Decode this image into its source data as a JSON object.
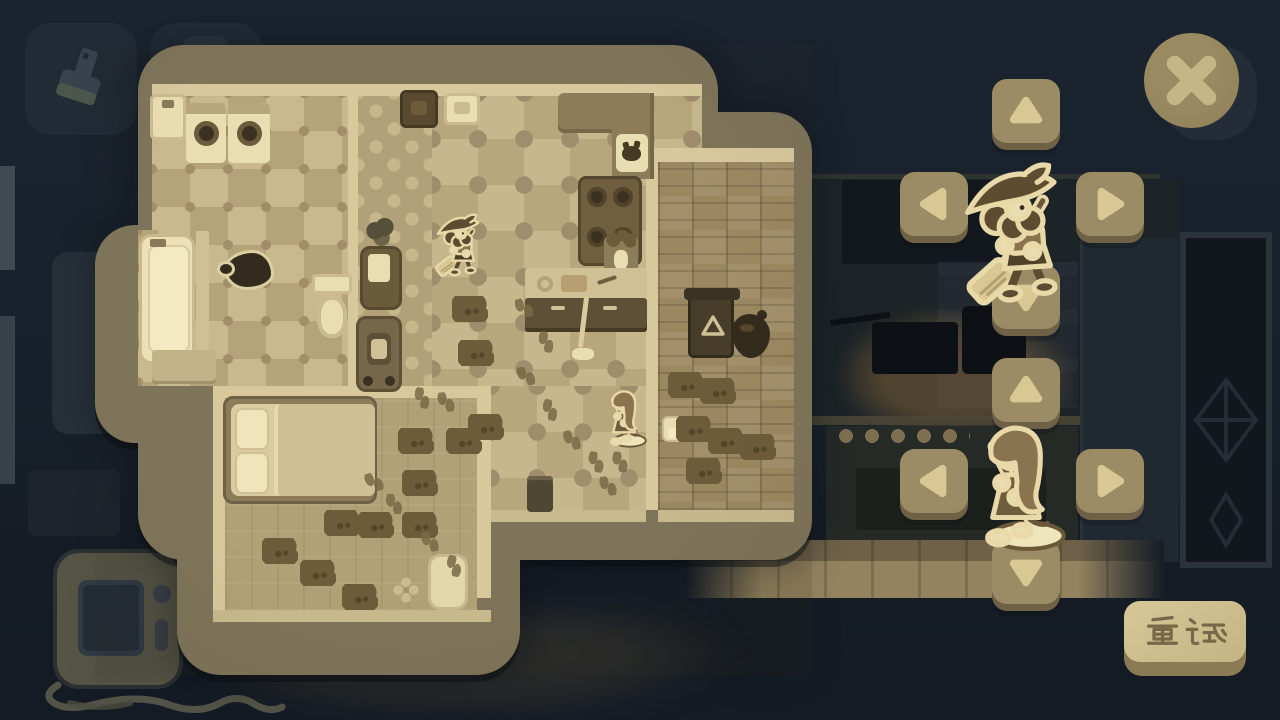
{
  "palette": {
    "bg": "#18212b",
    "bg_dark": "#141b24",
    "panel_border": "#7e745a",
    "wall": "#d8c99d",
    "wall_lip": "#c9ba8e",
    "checker_a": "#c9b98e",
    "checker_b": "#b5a479",
    "puzzle_a": "#c7b78c",
    "puzzle_b": "#b8a77c",
    "puzzle_dot": "#a08d6c",
    "corridor": "#b1a078",
    "parquet": "#9c8860",
    "carpet": "#b1a176",
    "cream": "#e9ddb2",
    "cream_bright": "#f1e7c0",
    "dark_furniture": "#5a4b30",
    "counter_dark": "#5e5036",
    "counter_top": "#cfc096",
    "mud": "#6d5c3a",
    "mud_dark": "#55462a",
    "footprint": "#7b6946",
    "stain": "#332c1e",
    "stain_outline": "#dcd0a2",
    "btn_face": "#9c8c65",
    "btn_arrow": "#d9c894",
    "btn_lip": "#6e6146",
    "close_face": "#8f8058",
    "close_x": "#c6b585",
    "close_shadow": "#242d37",
    "retry_face": "#cdbd8d",
    "retry_side": "#8a7b55",
    "retry_text_color": "#776849",
    "sprite_outline": "#ead9a8",
    "sprite_dark": "#5f4c30",
    "sprite_mid": "#8a7450",
    "sprite_cream": "#e9dcae",
    "hud_btn": "#212b36",
    "hud_icon": "#39434e",
    "console_body": "#555445",
    "console_screen": "#242e37"
  },
  "hud": {
    "brush_button": {
      "icon": "brush-icon"
    },
    "extra_button": {
      "icon": "button-behind-panel"
    },
    "close_button": {
      "icon": "close-x-icon"
    },
    "retry_button": {
      "label": "重试"
    }
  },
  "dpads": [
    {
      "id": "witch",
      "character": "witch-with-broom",
      "buttons": [
        {
          "dir": "up"
        },
        {
          "dir": "left"
        },
        {
          "dir": "right"
        },
        {
          "dir": "down"
        }
      ]
    },
    {
      "id": "maid",
      "character": "maid-with-mop",
      "buttons": [
        {
          "dir": "up"
        },
        {
          "dir": "left"
        },
        {
          "dir": "right"
        },
        {
          "dir": "down"
        }
      ]
    }
  ],
  "map": {
    "rooms": [
      {
        "name": "laundry-bathroom",
        "floor": "checker-tile"
      },
      {
        "name": "hallway",
        "floor": "clover-tile"
      },
      {
        "name": "kitchen-living",
        "floor": "puzzle-tile"
      },
      {
        "name": "wood-room",
        "floor": "parquet"
      },
      {
        "name": "bedroom",
        "floor": "carpet"
      }
    ],
    "objects": [
      "laundry-sink",
      "washing-machine",
      "washing-machine",
      "bathtub",
      "shower-divider",
      "toilet",
      "dresser",
      "dirt-stain",
      "potted-plant",
      "armchair",
      "stroller-chair",
      "tall-cabinet",
      "kitchen-sink",
      "l-counter",
      "cat-on-mat",
      "stove",
      "flower-vase",
      "kitchen-counter",
      "standing-broom",
      "small-trash-bin",
      "bed",
      "bedside-rug",
      "carpet-flower",
      "trash-bin-recycle",
      "trash-bag",
      "paper-towel"
    ],
    "decals": {
      "stains": [
        {
          "x": 224,
          "y": 250
        }
      ],
      "mud_piles": [
        {
          "x": 452,
          "y": 296
        },
        {
          "x": 458,
          "y": 340
        },
        {
          "x": 668,
          "y": 372
        },
        {
          "x": 700,
          "y": 378
        },
        {
          "x": 676,
          "y": 416
        },
        {
          "x": 708,
          "y": 428
        },
        {
          "x": 740,
          "y": 434
        },
        {
          "x": 686,
          "y": 458
        },
        {
          "x": 398,
          "y": 428
        },
        {
          "x": 446,
          "y": 428
        },
        {
          "x": 468,
          "y": 414
        },
        {
          "x": 402,
          "y": 470
        },
        {
          "x": 324,
          "y": 510
        },
        {
          "x": 358,
          "y": 512
        },
        {
          "x": 402,
          "y": 512
        },
        {
          "x": 300,
          "y": 560
        },
        {
          "x": 342,
          "y": 584
        },
        {
          "x": 262,
          "y": 538
        }
      ],
      "footprints": [
        {
          "x": 516,
          "y": 298,
          "r": -15
        },
        {
          "x": 538,
          "y": 332,
          "r": 10
        },
        {
          "x": 518,
          "y": 366,
          "r": -15
        },
        {
          "x": 542,
          "y": 400,
          "r": 12
        },
        {
          "x": 564,
          "y": 430,
          "r": -10
        },
        {
          "x": 588,
          "y": 452,
          "r": 8
        },
        {
          "x": 366,
          "y": 472,
          "r": -20
        },
        {
          "x": 386,
          "y": 494,
          "r": 0
        },
        {
          "x": 414,
          "y": 388,
          "r": 10
        },
        {
          "x": 438,
          "y": 392,
          "r": -6
        },
        {
          "x": 446,
          "y": 556,
          "r": 14
        },
        {
          "x": 422,
          "y": 532,
          "r": -8
        },
        {
          "x": 612,
          "y": 452,
          "r": 6
        },
        {
          "x": 600,
          "y": 476,
          "r": -8
        }
      ]
    },
    "characters": [
      {
        "name": "witch-with-broom",
        "x": 436,
        "y": 210
      },
      {
        "name": "maid-with-mop",
        "x": 602,
        "y": 390
      }
    ]
  }
}
